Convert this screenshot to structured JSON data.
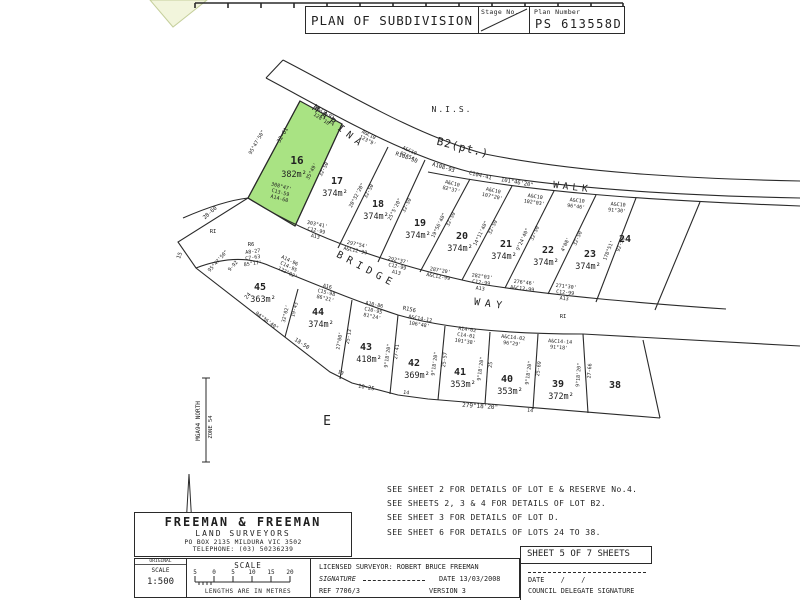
{
  "header": {
    "title": "PLAN OF SUBDIVISION",
    "stage_label": "Stage No.",
    "plan_number_label": "Plan Number",
    "plan_number": "PS 613558D"
  },
  "plan": {
    "highlight_color": "#a9e383",
    "labels": [
      {
        "t": "N.I.S.",
        "x": 452,
        "y": 112,
        "s": 8,
        "ls": 2
      },
      {
        "t": "MARINA",
        "x": 337,
        "y": 129,
        "s": 9.5,
        "r": 38,
        "ls": 5
      },
      {
        "t": "B2(pt.)",
        "x": 462,
        "y": 151,
        "s": 11,
        "r": 14,
        "ls": 1
      },
      {
        "t": "WALK",
        "x": 572,
        "y": 190,
        "s": 9.5,
        "r": 7,
        "ls": 4
      },
      {
        "t": "BRIDGE",
        "x": 365,
        "y": 272,
        "s": 10,
        "r": 28,
        "ls": 5
      },
      {
        "t": "WAY",
        "x": 490,
        "y": 307,
        "s": 10,
        "r": 8,
        "ls": 5
      },
      {
        "t": "E",
        "x": 327,
        "y": 425,
        "s": 13
      },
      {
        "t": "R108-50",
        "x": 406,
        "y": 159,
        "s": 5.5,
        "r": 20
      },
      {
        "t": "A108-93",
        "x": 443,
        "y": 169,
        "s": 5.5,
        "r": 17
      },
      {
        "t": "C104-41",
        "x": 480,
        "y": 177,
        "s": 5.5,
        "r": 13
      },
      {
        "t": "101°46'20\"",
        "x": 517,
        "y": 184,
        "s": 5.5,
        "r": 10
      },
      {
        "t": "RI",
        "x": 213,
        "y": 233,
        "s": 5.5
      },
      {
        "t": "R6",
        "x": 251,
        "y": 246,
        "s": 5.5
      },
      {
        "t": "RI",
        "x": 563,
        "y": 318,
        "s": 5.5
      },
      {
        "t": "R156",
        "x": 409,
        "y": 311,
        "s": 5.5,
        "r": 12
      },
      {
        "t": "A&C8-93",
        "x": 324,
        "y": 114,
        "s": 5,
        "r": 33
      },
      {
        "t": "128°10'",
        "x": 322,
        "y": 121,
        "s": 5,
        "r": 33
      },
      {
        "t": "32-61",
        "x": 284,
        "y": 136,
        "s": 5.5,
        "r": -60
      },
      {
        "t": "16",
        "x": 297,
        "y": 164,
        "s": 11,
        "b": 1
      },
      {
        "t": "382m²",
        "x": 294,
        "y": 177,
        "s": 8.5
      },
      {
        "t": "95°47'50\"",
        "x": 258,
        "y": 143,
        "s": 5,
        "r": -60
      },
      {
        "t": "308°47'",
        "x": 281,
        "y": 188,
        "s": 5,
        "r": 15
      },
      {
        "t": "C13-59",
        "x": 280,
        "y": 194,
        "s": 5,
        "r": 15
      },
      {
        "t": "A14-60",
        "x": 279,
        "y": 200,
        "s": 5,
        "r": 15
      },
      {
        "t": "35°49'",
        "x": 313,
        "y": 172,
        "s": 5,
        "r": -62
      },
      {
        "t": "32-50",
        "x": 325,
        "y": 170,
        "s": 5,
        "r": -62
      },
      {
        "t": "A&C10",
        "x": 368,
        "y": 136,
        "s": 5,
        "r": 28
      },
      {
        "t": "123°9'",
        "x": 367,
        "y": 142,
        "s": 5,
        "r": 28
      },
      {
        "t": "17",
        "x": 337,
        "y": 184,
        "s": 10,
        "b": 1
      },
      {
        "t": "374m²",
        "x": 335,
        "y": 196,
        "s": 8.5
      },
      {
        "t": "20°32'20\"",
        "x": 358,
        "y": 196,
        "s": 5,
        "r": -62
      },
      {
        "t": "32-50",
        "x": 370,
        "y": 192,
        "s": 5,
        "r": -62
      },
      {
        "t": "303°41'",
        "x": 317,
        "y": 226,
        "s": 5,
        "r": 12
      },
      {
        "t": "C12-99",
        "x": 316,
        "y": 232,
        "s": 5,
        "r": 12
      },
      {
        "t": "A13",
        "x": 315,
        "y": 238,
        "s": 5,
        "r": 12
      },
      {
        "t": "A&C10",
        "x": 409,
        "y": 152,
        "s": 5,
        "r": 24
      },
      {
        "t": "87°54'",
        "x": 408,
        "y": 158,
        "s": 5,
        "r": 24
      },
      {
        "t": "18",
        "x": 378,
        "y": 207,
        "s": 10,
        "b": 1
      },
      {
        "t": "374m²",
        "x": 376,
        "y": 219,
        "s": 8.5
      },
      {
        "t": "25°5'20\"",
        "x": 396,
        "y": 210,
        "s": 5,
        "r": -63
      },
      {
        "t": "32-50",
        "x": 408,
        "y": 206,
        "s": 5,
        "r": -63
      },
      {
        "t": "297°54'",
        "x": 357,
        "y": 246,
        "s": 5,
        "r": 12
      },
      {
        "t": "A&C12-99",
        "x": 355,
        "y": 252,
        "s": 5,
        "r": 12
      },
      {
        "t": "A&C10",
        "x": 452,
        "y": 185,
        "s": 5,
        "r": 14
      },
      {
        "t": "82°37'",
        "x": 451,
        "y": 191,
        "s": 5,
        "r": 14
      },
      {
        "t": "19",
        "x": 420,
        "y": 226,
        "s": 10,
        "b": 1
      },
      {
        "t": "374m²",
        "x": 418,
        "y": 238,
        "s": 8.5
      },
      {
        "t": "19°56'40\"",
        "x": 440,
        "y": 226,
        "s": 5,
        "r": -64
      },
      {
        "t": "32-50",
        "x": 452,
        "y": 220,
        "s": 5,
        "r": -64
      },
      {
        "t": "292°37'",
        "x": 398,
        "y": 262,
        "s": 5,
        "r": 12
      },
      {
        "t": "C12-99",
        "x": 397,
        "y": 268,
        "s": 5,
        "r": 12
      },
      {
        "t": "A13",
        "x": 396,
        "y": 274,
        "s": 5,
        "r": 12
      },
      {
        "t": "A&C10",
        "x": 493,
        "y": 192,
        "s": 5,
        "r": 12
      },
      {
        "t": "107°20'",
        "x": 492,
        "y": 198,
        "s": 5,
        "r": 12
      },
      {
        "t": "20",
        "x": 462,
        "y": 239,
        "s": 10,
        "b": 1
      },
      {
        "t": "374m²",
        "x": 460,
        "y": 251,
        "s": 8.5
      },
      {
        "t": "14°11'40\"",
        "x": 482,
        "y": 234,
        "s": 5,
        "r": -64
      },
      {
        "t": "32-50",
        "x": 494,
        "y": 228,
        "s": 5,
        "r": -64
      },
      {
        "t": "287°20'",
        "x": 440,
        "y": 272,
        "s": 5,
        "r": 10
      },
      {
        "t": "A&C12-99",
        "x": 438,
        "y": 278,
        "s": 5,
        "r": 10
      },
      {
        "t": "A&C10",
        "x": 535,
        "y": 198,
        "s": 5,
        "r": 9
      },
      {
        "t": "102°03'",
        "x": 534,
        "y": 204,
        "s": 5,
        "r": 9
      },
      {
        "t": "21",
        "x": 506,
        "y": 247,
        "s": 10,
        "b": 1
      },
      {
        "t": "374m²",
        "x": 504,
        "y": 259,
        "s": 8.5
      },
      {
        "t": "9°24'40\"",
        "x": 524,
        "y": 240,
        "s": 5,
        "r": -65
      },
      {
        "t": "32-50",
        "x": 536,
        "y": 234,
        "s": 5,
        "r": -65
      },
      {
        "t": "282°03'",
        "x": 482,
        "y": 278,
        "s": 5,
        "r": 8
      },
      {
        "t": "C12-99",
        "x": 481,
        "y": 284,
        "s": 5,
        "r": 8
      },
      {
        "t": "A13",
        "x": 480,
        "y": 290,
        "s": 5,
        "r": 8
      },
      {
        "t": "A&C10",
        "x": 577,
        "y": 202,
        "s": 5,
        "r": 7
      },
      {
        "t": "96°46'",
        "x": 576,
        "y": 208,
        "s": 5,
        "r": 7
      },
      {
        "t": "22",
        "x": 548,
        "y": 253,
        "s": 10,
        "b": 1
      },
      {
        "t": "374m²",
        "x": 546,
        "y": 265,
        "s": 8.5
      },
      {
        "t": "4°08'",
        "x": 567,
        "y": 245,
        "s": 5,
        "r": -66
      },
      {
        "t": "32-50",
        "x": 579,
        "y": 239,
        "s": 5,
        "r": -66
      },
      {
        "t": "276°46'",
        "x": 524,
        "y": 284,
        "s": 5,
        "r": 7
      },
      {
        "t": "A&C12-99",
        "x": 522,
        "y": 290,
        "s": 5,
        "r": 7
      },
      {
        "t": "A&C10",
        "x": 618,
        "y": 206,
        "s": 5,
        "r": 5
      },
      {
        "t": "91°30'",
        "x": 617,
        "y": 212,
        "s": 5,
        "r": 5
      },
      {
        "t": "23",
        "x": 590,
        "y": 257,
        "s": 10,
        "b": 1
      },
      {
        "t": "374m²",
        "x": 588,
        "y": 269,
        "s": 8.5
      },
      {
        "t": "178°51'",
        "x": 610,
        "y": 251,
        "s": 5,
        "r": -68
      },
      {
        "t": "92-50",
        "x": 622,
        "y": 245,
        "s": 5,
        "r": -68
      },
      {
        "t": "271°30'",
        "x": 566,
        "y": 288,
        "s": 5,
        "r": 6
      },
      {
        "t": "C12-99",
        "x": 565,
        "y": 294,
        "s": 5,
        "r": 6
      },
      {
        "t": "A13",
        "x": 564,
        "y": 300,
        "s": 5,
        "r": 6
      },
      {
        "t": "24",
        "x": 625,
        "y": 242,
        "s": 10,
        "b": 1
      },
      {
        "t": "28-60",
        "x": 211,
        "y": 214,
        "s": 5.5,
        "r": -42
      },
      {
        "t": "15",
        "x": 181,
        "y": 256,
        "s": 5.5,
        "r": -70
      },
      {
        "t": "95°47'50\"",
        "x": 219,
        "y": 262,
        "s": 5,
        "r": -48
      },
      {
        "t": "9-92",
        "x": 234,
        "y": 267,
        "s": 5,
        "r": -48
      },
      {
        "t": "24",
        "x": 249,
        "y": 297,
        "s": 5.5,
        "r": -48
      },
      {
        "t": "94°36'40\"",
        "x": 266,
        "y": 322,
        "s": 5,
        "r": 36
      },
      {
        "t": "18-50",
        "x": 301,
        "y": 345,
        "s": 5.5,
        "r": 33
      },
      {
        "t": "10",
        "x": 340,
        "y": 374,
        "s": 5,
        "r": 22
      },
      {
        "t": "10-25",
        "x": 366,
        "y": 389,
        "s": 5.5,
        "r": 10
      },
      {
        "t": "14",
        "x": 406,
        "y": 394,
        "s": 5,
        "r": 8
      },
      {
        "t": "279°18'20\"",
        "x": 480,
        "y": 408,
        "s": 6,
        "r": 4
      },
      {
        "t": "14",
        "x": 530,
        "y": 412,
        "s": 5,
        "r": 4
      },
      {
        "t": "A8-27",
        "x": 253,
        "y": 253,
        "s": 5,
        "r": -8
      },
      {
        "t": "C7-63",
        "x": 253,
        "y": 259,
        "s": 5,
        "r": -8
      },
      {
        "t": "85°17'",
        "x": 253,
        "y": 265,
        "s": 5,
        "r": -8
      },
      {
        "t": "A14-96",
        "x": 289,
        "y": 262,
        "s": 5,
        "r": 26
      },
      {
        "t": "C14-95",
        "x": 288,
        "y": 268,
        "s": 5,
        "r": 26
      },
      {
        "t": "122°02'",
        "x": 287,
        "y": 274,
        "s": 5,
        "r": 26
      },
      {
        "t": "45",
        "x": 260,
        "y": 290,
        "s": 10,
        "b": 1
      },
      {
        "t": "363m²",
        "x": 263,
        "y": 302,
        "s": 8.5
      },
      {
        "t": "32°02'",
        "x": 287,
        "y": 314,
        "s": 5,
        "r": -76
      },
      {
        "t": "19-43",
        "x": 296,
        "y": 310,
        "s": 5,
        "r": -76
      },
      {
        "t": "A16",
        "x": 327,
        "y": 288,
        "s": 5,
        "r": 14
      },
      {
        "t": "C15-98",
        "x": 326,
        "y": 294,
        "s": 5,
        "r": 14
      },
      {
        "t": "86°21'",
        "x": 325,
        "y": 300,
        "s": 5,
        "r": 14
      },
      {
        "t": "44",
        "x": 318,
        "y": 315,
        "s": 10,
        "b": 1
      },
      {
        "t": "374m²",
        "x": 321,
        "y": 327,
        "s": 8.5
      },
      {
        "t": "27°00'",
        "x": 341,
        "y": 341,
        "s": 5,
        "r": -80
      },
      {
        "t": "25-13",
        "x": 350,
        "y": 337,
        "s": 5,
        "r": -80
      },
      {
        "t": "A10-86",
        "x": 374,
        "y": 306,
        "s": 5,
        "r": 12
      },
      {
        "t": "C10-95",
        "x": 373,
        "y": 312,
        "s": 5,
        "r": 12
      },
      {
        "t": "81°24'",
        "x": 372,
        "y": 318,
        "s": 5,
        "r": 12
      },
      {
        "t": "43",
        "x": 366,
        "y": 350,
        "s": 10,
        "b": 1
      },
      {
        "t": "418m²",
        "x": 369,
        "y": 362,
        "s": 8.5
      },
      {
        "t": "9°18'20\"",
        "x": 389,
        "y": 356,
        "s": 5,
        "r": -82
      },
      {
        "t": "27-41",
        "x": 398,
        "y": 352,
        "s": 5,
        "r": -82
      },
      {
        "t": "A&C14-12",
        "x": 420,
        "y": 320,
        "s": 5,
        "r": 10
      },
      {
        "t": "106°48'",
        "x": 419,
        "y": 326,
        "s": 5,
        "r": 10
      },
      {
        "t": "42",
        "x": 414,
        "y": 366,
        "s": 10,
        "b": 1
      },
      {
        "t": "369m²",
        "x": 417,
        "y": 378,
        "s": 8.5
      },
      {
        "t": "9°18'20\"",
        "x": 436,
        "y": 364,
        "s": 5,
        "r": -82
      },
      {
        "t": "25-57",
        "x": 446,
        "y": 360,
        "s": 5,
        "r": -82
      },
      {
        "t": "A14-02",
        "x": 467,
        "y": 331,
        "s": 5,
        "r": 8
      },
      {
        "t": "C14-01",
        "x": 466,
        "y": 337,
        "s": 5,
        "r": 8
      },
      {
        "t": "101°38'",
        "x": 465,
        "y": 343,
        "s": 5,
        "r": 8
      },
      {
        "t": "41",
        "x": 460,
        "y": 375,
        "s": 10,
        "b": 1
      },
      {
        "t": "353m²",
        "x": 463,
        "y": 387,
        "s": 8.5
      },
      {
        "t": "9°18'20\"",
        "x": 482,
        "y": 369,
        "s": 5,
        "r": -82
      },
      {
        "t": "25",
        "x": 492,
        "y": 365,
        "s": 5,
        "r": -82
      },
      {
        "t": "A&C14-02",
        "x": 513,
        "y": 339,
        "s": 5,
        "r": 6
      },
      {
        "t": "96°29'",
        "x": 512,
        "y": 345,
        "s": 5,
        "r": 6
      },
      {
        "t": "40",
        "x": 507,
        "y": 382,
        "s": 10,
        "b": 1
      },
      {
        "t": "353m²",
        "x": 510,
        "y": 394,
        "s": 8.5
      },
      {
        "t": "9°18'20\"",
        "x": 530,
        "y": 373,
        "s": 5,
        "r": -82
      },
      {
        "t": "25-69",
        "x": 540,
        "y": 369,
        "s": 5,
        "r": -82
      },
      {
        "t": "A&C14-14",
        "x": 560,
        "y": 343,
        "s": 5,
        "r": 4
      },
      {
        "t": "91°18'",
        "x": 559,
        "y": 349,
        "s": 5,
        "r": 4
      },
      {
        "t": "39",
        "x": 558,
        "y": 387,
        "s": 10,
        "b": 1
      },
      {
        "t": "372m²",
        "x": 561,
        "y": 399,
        "s": 8.5
      },
      {
        "t": "9°18'20\"",
        "x": 580,
        "y": 375,
        "s": 5,
        "r": -86
      },
      {
        "t": "27-66",
        "x": 591,
        "y": 371,
        "s": 5,
        "r": -86
      },
      {
        "t": "38",
        "x": 615,
        "y": 388,
        "s": 10,
        "b": 1
      },
      {
        "t": "MGA94 NORTH",
        "x": 200,
        "y": 421,
        "s": 6,
        "r": -90
      },
      {
        "t": "ZONE 54",
        "x": 212,
        "y": 427,
        "s": 5.5,
        "r": -90
      }
    ]
  },
  "notes": {
    "lines": [
      "SEE SHEET 2 FOR DETAILS OF LOT E & RESERVE No.4.",
      "SEE SHEETS 2, 3 & 4 FOR DETAILS OF LOT B2.",
      "SEE SHEET 3 FOR DETAILS OF LOT D.",
      "SEE SHEET 6 FOR DETAILS OF LOTS 24 TO 38."
    ]
  },
  "surveyor_box": {
    "name": "FREEMAN & FREEMAN",
    "subtitle": "LAND SURVEYORS",
    "address": "PO BOX 2135  MILDURA  VIC  3502",
    "phone": "TELEPHONE: (03) 50236239"
  },
  "footer": {
    "original_label": "ORIGINAL",
    "scale_label": "SCALE",
    "scale_value": "1:500",
    "scalebar_title": "SCALE",
    "scalebar_ticks": [
      "5",
      "0",
      "5",
      "10",
      "15",
      "20"
    ],
    "scalebar_caption": "LENGTHS ARE IN METRES",
    "licensed_surveyor": "LICENSED SURVEYOR: ROBERT BRUCE FREEMAN",
    "signature_label": "SIGNATURE",
    "date_label": "DATE 13/03/2008",
    "ref": "REF 7706/3",
    "version": "VERSION 3",
    "sheet": "SHEET 5 OF 7 SHEETS",
    "council_date_line": "DATE    /    /",
    "council_sig_label": "COUNCIL DELEGATE SIGNATURE"
  }
}
